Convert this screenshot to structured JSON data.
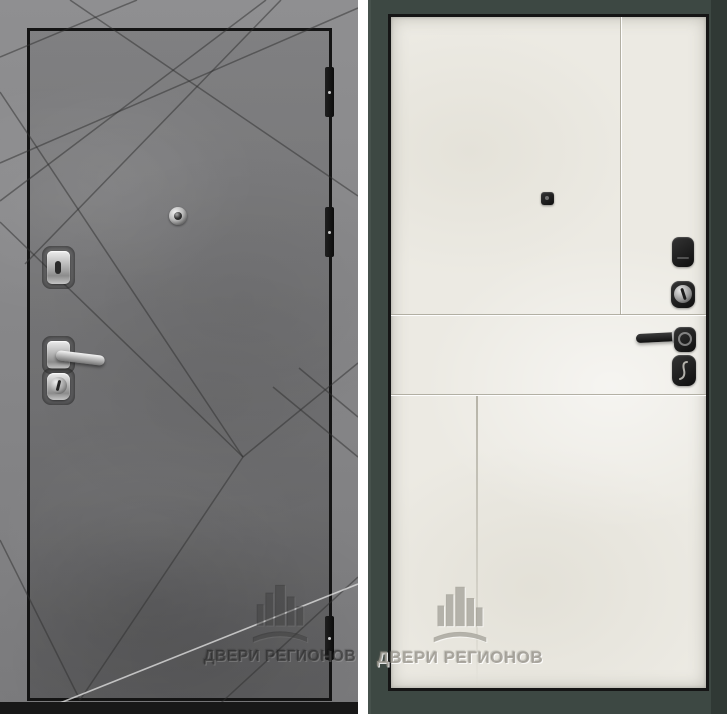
{
  "brand_watermark": {
    "text": "ДВЕРИ РЕГИОНОВ",
    "logo_icon": "city-buildings-logo"
  },
  "front_view": {
    "finish": "gray-concrete",
    "pattern": "diagonal-ray-grooves",
    "surface_color": "#6f6f72",
    "outer_edge_color": "#8b8b8d",
    "hinge_count": 3,
    "hardware_finish": "chrome",
    "hardware": [
      "peephole",
      "keyhole-escutcheon",
      "lever-handle",
      "cylinder-lock"
    ]
  },
  "back_view": {
    "finish": "light-cream-panel",
    "pattern": "flat-panel-seams",
    "frame_color": "#3d4843",
    "panel_color": "#eceae3",
    "hardware_finish": "black",
    "hardware": [
      "peephole",
      "lock-escutcheon",
      "cylinder-lock",
      "lever-handle",
      "night-latch"
    ]
  }
}
